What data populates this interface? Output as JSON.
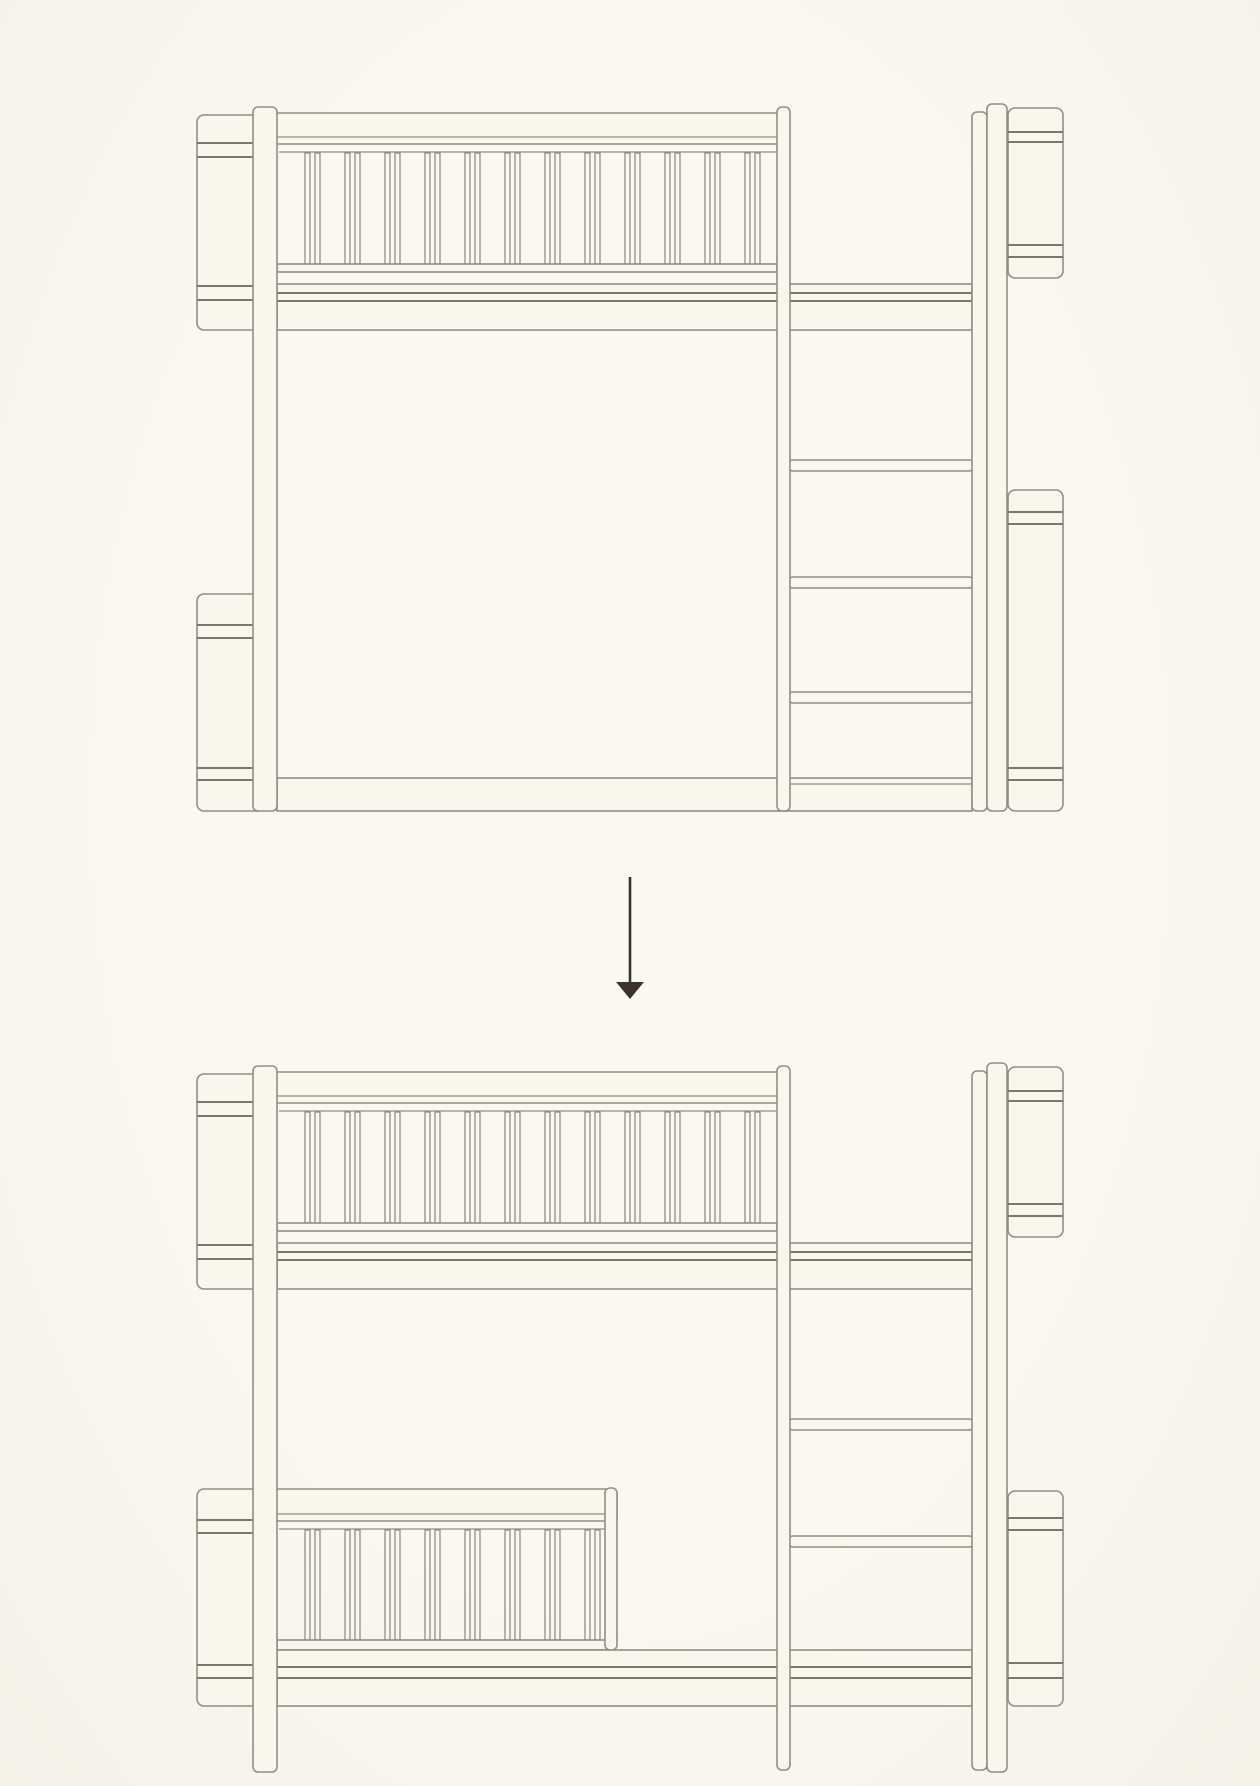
{
  "style": {
    "background": "#f9f6ee",
    "line": "#948d84",
    "line_strong": "#7d766d",
    "fill": "#f9f6ee",
    "arrow_color": "#3b332c"
  },
  "diagram": {
    "figures": [
      {
        "name": "bunk-bed-before",
        "parts": [
          [
            "rrect",
            197,
            115,
            68,
            215,
            7,
            "panel-upper-left"
          ],
          [
            "hline",
            197,
            265,
            143
          ],
          [
            "hline",
            197,
            265,
            157
          ],
          [
            "hline",
            197,
            265,
            286
          ],
          [
            "hline",
            197,
            265,
            300
          ],
          [
            "rrect",
            197,
            594,
            68,
            217,
            7,
            "panel-lower-left"
          ],
          [
            "hline",
            197,
            265,
            625
          ],
          [
            "hline",
            197,
            265,
            638
          ],
          [
            "hline",
            197,
            265,
            768
          ],
          [
            "hline",
            197,
            265,
            780
          ],
          [
            "rrect",
            1008,
            108,
            55,
            170,
            7,
            "panel-upper-right"
          ],
          [
            "hline",
            1008,
            1063,
            132
          ],
          [
            "hline",
            1008,
            1063,
            142
          ],
          [
            "hline",
            1008,
            1063,
            245
          ],
          [
            "hline",
            1008,
            1063,
            257
          ],
          [
            "rrect",
            1008,
            490,
            55,
            321,
            7,
            "panel-lower-right"
          ],
          [
            "hline",
            1008,
            1063,
            512
          ],
          [
            "hline",
            1008,
            1063,
            524
          ],
          [
            "hline",
            1008,
            1063,
            768
          ],
          [
            "hline",
            1008,
            1063,
            780
          ],
          [
            "rrect",
            260,
            113,
            528,
            31,
            4,
            "top-rail"
          ],
          [
            "iline",
            264,
            786,
            137
          ],
          [
            "iline",
            279,
            776,
            152
          ],
          [
            "slats",
            305,
            12,
            153,
            111,
            "upper-railing-slats"
          ],
          [
            "rect",
            277,
            264,
            500,
            8,
            "railing-bottom-rail"
          ],
          [
            "rect",
            277,
            284,
            695,
            46,
            "upper-bed-base"
          ],
          [
            "hline",
            277,
            972,
            293
          ],
          [
            "hline",
            277,
            972,
            301
          ],
          [
            "rrect",
            788,
            460,
            186,
            11,
            5,
            "ladder-rung-1"
          ],
          [
            "rrect",
            788,
            577,
            186,
            11,
            5,
            "ladder-rung-2"
          ],
          [
            "rrect",
            788,
            692,
            186,
            11,
            5,
            "ladder-rung-3"
          ],
          [
            "rect",
            277,
            778,
            695,
            33,
            "bottom-rail-band"
          ],
          [
            "iline",
            790,
            972,
            784
          ],
          [
            "rrect",
            253,
            107,
            24,
            704,
            5,
            "left-leg"
          ],
          [
            "rrect",
            777,
            107,
            13,
            704,
            5,
            "ladder-left-rail"
          ],
          [
            "rrect",
            972,
            112,
            15,
            699,
            5,
            "ladder-right-rail"
          ],
          [
            "rrect",
            987,
            104,
            20,
            707,
            5,
            "right-post"
          ]
        ]
      },
      {
        "name": "bunk-bed-after",
        "parts": [
          [
            "rrect",
            197,
            1074,
            68,
            215,
            7,
            "panel-upper-left"
          ],
          [
            "hline",
            197,
            265,
            1102
          ],
          [
            "hline",
            197,
            265,
            1116
          ],
          [
            "hline",
            197,
            265,
            1245
          ],
          [
            "hline",
            197,
            265,
            1259
          ],
          [
            "rrect",
            197,
            1489,
            68,
            217,
            7,
            "panel-lower-left"
          ],
          [
            "hline",
            197,
            265,
            1520
          ],
          [
            "hline",
            197,
            265,
            1533
          ],
          [
            "hline",
            197,
            265,
            1665
          ],
          [
            "hline",
            197,
            265,
            1678
          ],
          [
            "rrect",
            1008,
            1067,
            55,
            170,
            7,
            "panel-upper-right"
          ],
          [
            "hline",
            1008,
            1063,
            1091
          ],
          [
            "hline",
            1008,
            1063,
            1101
          ],
          [
            "hline",
            1008,
            1063,
            1204
          ],
          [
            "hline",
            1008,
            1063,
            1216
          ],
          [
            "rrect",
            1008,
            1491,
            55,
            215,
            7,
            "panel-lower-right"
          ],
          [
            "hline",
            1008,
            1063,
            1518
          ],
          [
            "hline",
            1008,
            1063,
            1530
          ],
          [
            "hline",
            1008,
            1063,
            1663
          ],
          [
            "hline",
            1008,
            1063,
            1678
          ],
          [
            "rrect",
            260,
            1072,
            528,
            31,
            4,
            "top-rail"
          ],
          [
            "iline",
            264,
            786,
            1096
          ],
          [
            "iline",
            279,
            776,
            1111
          ],
          [
            "slats",
            305,
            12,
            1112,
            111,
            "upper-railing-slats"
          ],
          [
            "rect",
            277,
            1223,
            500,
            8,
            "railing-bottom-rail"
          ],
          [
            "rect",
            277,
            1243,
            695,
            46,
            "upper-bed-base"
          ],
          [
            "hline",
            277,
            972,
            1252
          ],
          [
            "hline",
            277,
            972,
            1260
          ],
          [
            "rrect",
            788,
            1419,
            186,
            11,
            5,
            "ladder-rung-1"
          ],
          [
            "rrect",
            788,
            1536,
            186,
            11,
            5,
            "ladder-rung-2"
          ],
          [
            "rrect",
            260,
            1489,
            357,
            32,
            4,
            "lower-guard-rail"
          ],
          [
            "iline",
            264,
            612,
            1514
          ],
          [
            "iline",
            279,
            607,
            1529
          ],
          [
            "slats",
            305,
            8,
            1530,
            110,
            "lower-railing-slats"
          ],
          [
            "rect",
            277,
            1640,
            330,
            10,
            "lower-railing-bottom-rail"
          ],
          [
            "rrect",
            605,
            1488,
            12,
            162,
            5,
            "lower-railing-post"
          ],
          [
            "rect",
            277,
            1650,
            695,
            56,
            "lower-bed-base"
          ],
          [
            "hline",
            277,
            972,
            1667
          ],
          [
            "hline",
            277,
            972,
            1678
          ],
          [
            "rrect",
            253,
            1066,
            24,
            706,
            5,
            "left-leg"
          ],
          [
            "rrect",
            777,
            1066,
            13,
            704,
            5,
            "ladder-left-rail"
          ],
          [
            "rrect",
            972,
            1071,
            15,
            699,
            5,
            "ladder-right-rail"
          ],
          [
            "rrect",
            987,
            1063,
            20,
            709,
            5,
            "right-post"
          ]
        ]
      }
    ],
    "arrow": {
      "x": 630,
      "shaft_top": 877,
      "shaft_bottom": 986,
      "tip_y": 999,
      "head_top": 982,
      "head_half_width": 14,
      "shaft_width": 2.6
    }
  }
}
